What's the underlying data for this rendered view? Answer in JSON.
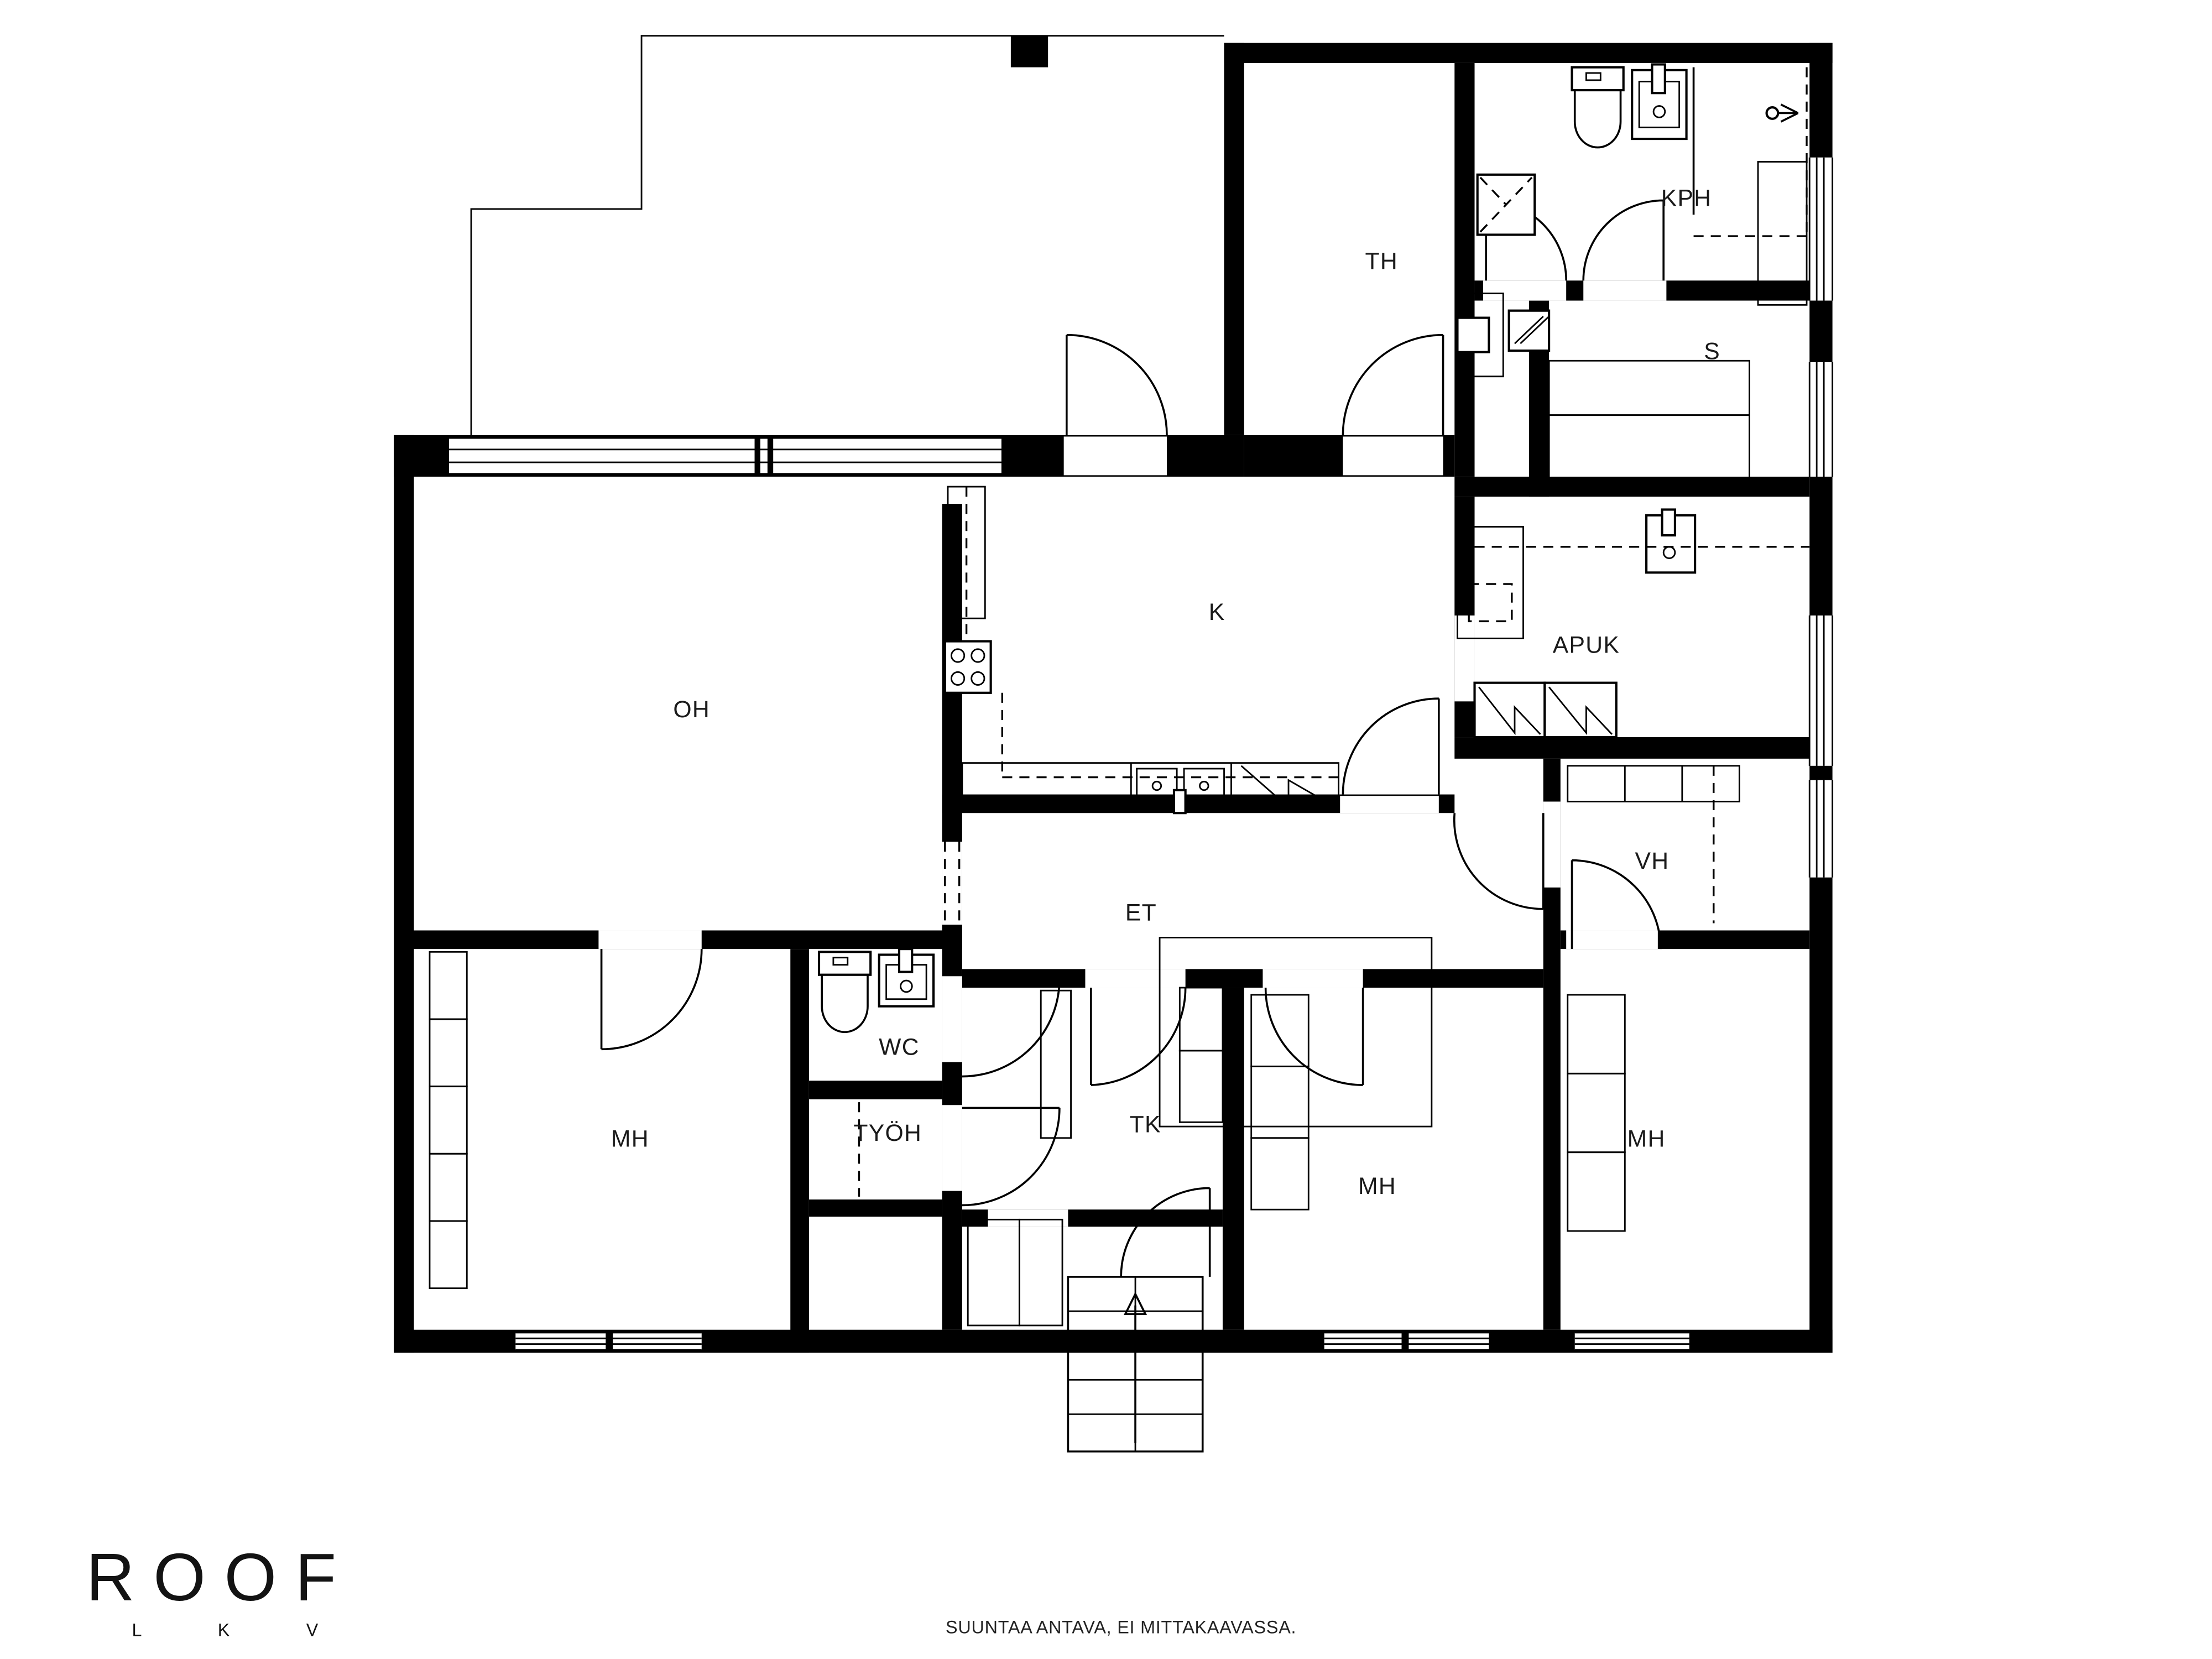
{
  "document": {
    "type": "floor-plan",
    "language": "fi"
  },
  "colors": {
    "wall": "#000000",
    "background": "#ffffff",
    "line": "#1a1a1a"
  },
  "rooms": [
    {
      "id": "th",
      "label": "TH"
    },
    {
      "id": "kph",
      "label": "KPH"
    },
    {
      "id": "s",
      "label": "S"
    },
    {
      "id": "k",
      "label": "K"
    },
    {
      "id": "apuk",
      "label": "APUK"
    },
    {
      "id": "oh",
      "label": "OH"
    },
    {
      "id": "vh",
      "label": "VH"
    },
    {
      "id": "et",
      "label": "ET"
    },
    {
      "id": "wc",
      "label": "WC"
    },
    {
      "id": "mh-left",
      "label": "MH"
    },
    {
      "id": "tyoh",
      "label": "TYÖH"
    },
    {
      "id": "tk",
      "label": "TK"
    },
    {
      "id": "mh-mid",
      "label": "MH"
    },
    {
      "id": "mh-right",
      "label": "MH"
    }
  ],
  "brand": {
    "logo_text": "ROOF",
    "logo_sub": "L K V"
  },
  "footer": {
    "disclaimer": "SUUNTAA ANTAVA, EI MITTAKAAVASSA."
  }
}
